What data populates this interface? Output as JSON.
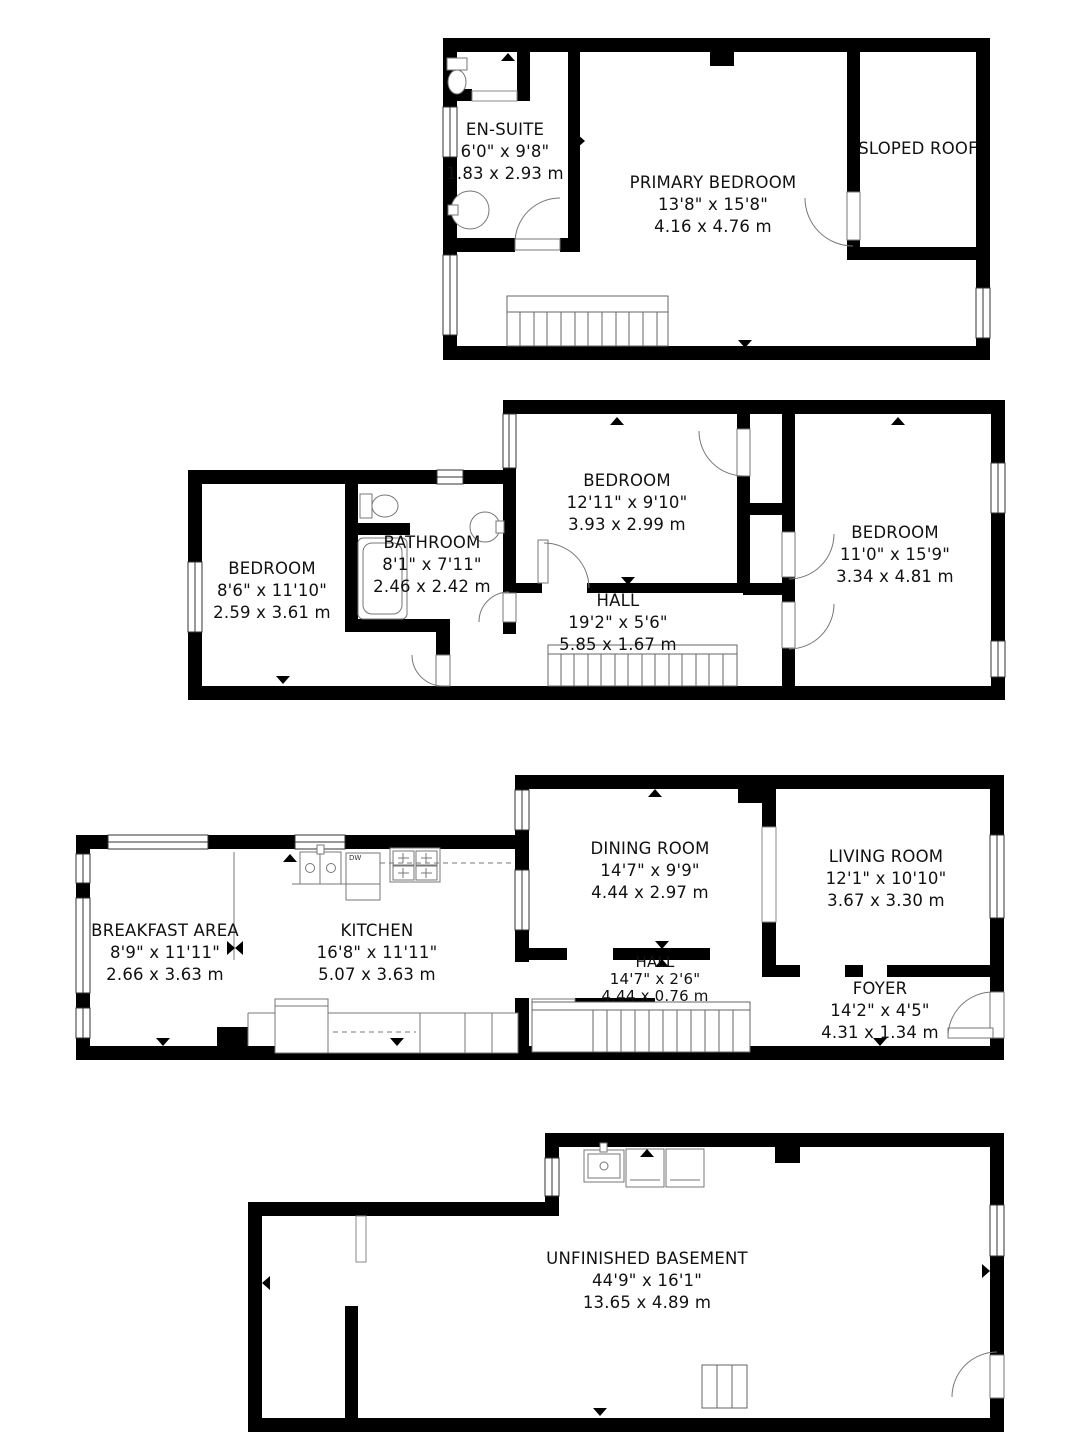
{
  "colors": {
    "wall": "#000000",
    "background": "#ffffff",
    "fixture_line": "#666666",
    "text": "#111111"
  },
  "floors": {
    "top": {
      "rooms": {
        "en_suite": {
          "name": "EN-SUITE",
          "imperial": "6'0\" x 9'8\"",
          "metric": "1.83 x 2.93 m"
        },
        "primary_bedroom": {
          "name": "PRIMARY BEDROOM",
          "imperial": "13'8\" x 15'8\"",
          "metric": "4.16 x 4.76 m"
        },
        "sloped_roof": {
          "name": "SLOPED ROOF"
        }
      }
    },
    "second": {
      "rooms": {
        "bedroom_left": {
          "name": "BEDROOM",
          "imperial": "8'6\" x 11'10\"",
          "metric": "2.59 x 3.61 m"
        },
        "bathroom": {
          "name": "BATHROOM",
          "imperial": "8'1\" x 7'11\"",
          "metric": "2.46 x 2.42 m"
        },
        "bedroom_middle": {
          "name": "BEDROOM",
          "imperial": "12'11\" x 9'10\"",
          "metric": "3.93 x 2.99 m"
        },
        "bedroom_right": {
          "name": "BEDROOM",
          "imperial": "11'0\" x 15'9\"",
          "metric": "3.34 x 4.81 m"
        },
        "hall": {
          "name": "HALL",
          "imperial": "19'2\" x 5'6\"",
          "metric": "5.85 x 1.67 m"
        }
      }
    },
    "main": {
      "labels": {
        "dishwasher": "DW"
      },
      "rooms": {
        "breakfast_area": {
          "name": "BREAKFAST AREA",
          "imperial": "8'9\" x 11'11\"",
          "metric": "2.66 x 3.63 m"
        },
        "kitchen": {
          "name": "KITCHEN",
          "imperial": "16'8\" x 11'11\"",
          "metric": "5.07 x 3.63 m"
        },
        "dining_room": {
          "name": "DINING ROOM",
          "imperial": "14'7\" x 9'9\"",
          "metric": "4.44 x 2.97 m"
        },
        "living_room": {
          "name": "LIVING ROOM",
          "imperial": "12'1\" x 10'10\"",
          "metric": "3.67 x 3.30 m"
        },
        "hall": {
          "name": "HALL",
          "imperial": "14'7\" x 2'6\"",
          "metric": "4.44 x 0.76 m"
        },
        "foyer": {
          "name": "FOYER",
          "imperial": "14'2\" x 4'5\"",
          "metric": "4.31 x 1.34 m"
        }
      }
    },
    "basement": {
      "rooms": {
        "unfinished_basement": {
          "name": "UNFINISHED BASEMENT",
          "imperial": "44'9\" x 16'1\"",
          "metric": "13.65 x 4.89 m"
        }
      }
    }
  }
}
